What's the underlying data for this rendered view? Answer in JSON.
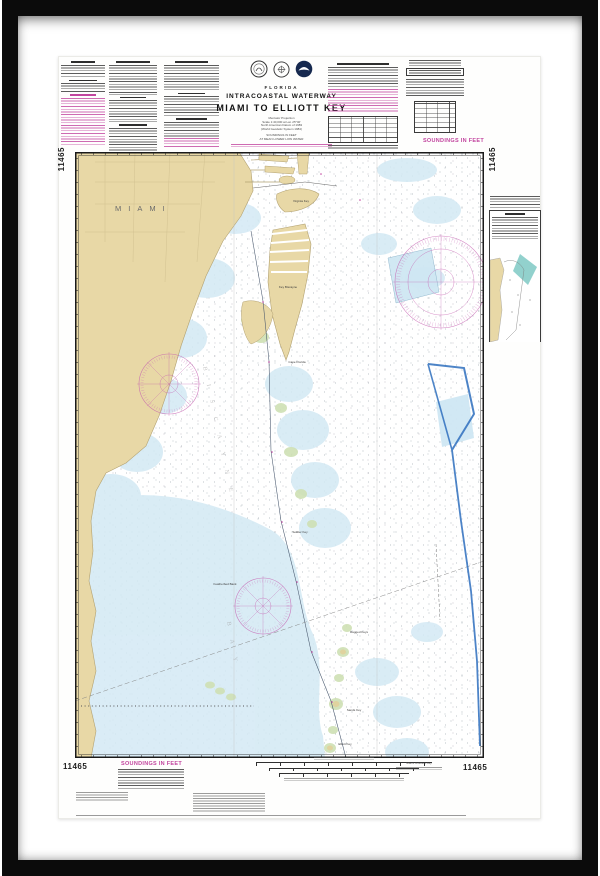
{
  "artwork": {
    "margin": {
      "chart_number": "11465",
      "soundings_label": "SOUNDINGS IN FEET",
      "bottom_right_caption": "Miami to Elliott Key"
    },
    "title_block": {
      "state": "FLORIDA",
      "title": "INTRACOASTAL WATERWAY",
      "subtitle": "MIAMI TO ELLIOTT KEY",
      "notes1": [
        "Mercator Projection",
        "Scale 1:40,000 at Lat. 25°40'",
        "North American Datum of 1983",
        "(World Geodetic System 1984)"
      ],
      "notes2": [
        "SOUNDINGS IN FEET",
        "AT MEAN LOWER LOW WATER"
      ]
    },
    "logos": [
      "commerce-seal",
      "transportation-seal",
      "noaa-emblem"
    ],
    "colors": {
      "land_tan": "#e8d8a6",
      "shallow_blue": "#d3e9f4",
      "marsh_green": "#cfe0b4",
      "chart_magenta": "#c2459f",
      "boundary_blue": "#2e6fbe",
      "inset_teal": "#86ccc8",
      "frame_black": "#0b0b0b"
    }
  },
  "map": {
    "city_label": "MIAMI",
    "bay_label_1": "BISCAYNE",
    "bay_label_2": "BAY",
    "features": [
      "Virginia Key",
      "Key Biscayne",
      "Cape Florida",
      "Soldier Key",
      "Featherbed Bank",
      "Ragged Keys",
      "Sands Key",
      "Elliott Key"
    ]
  }
}
